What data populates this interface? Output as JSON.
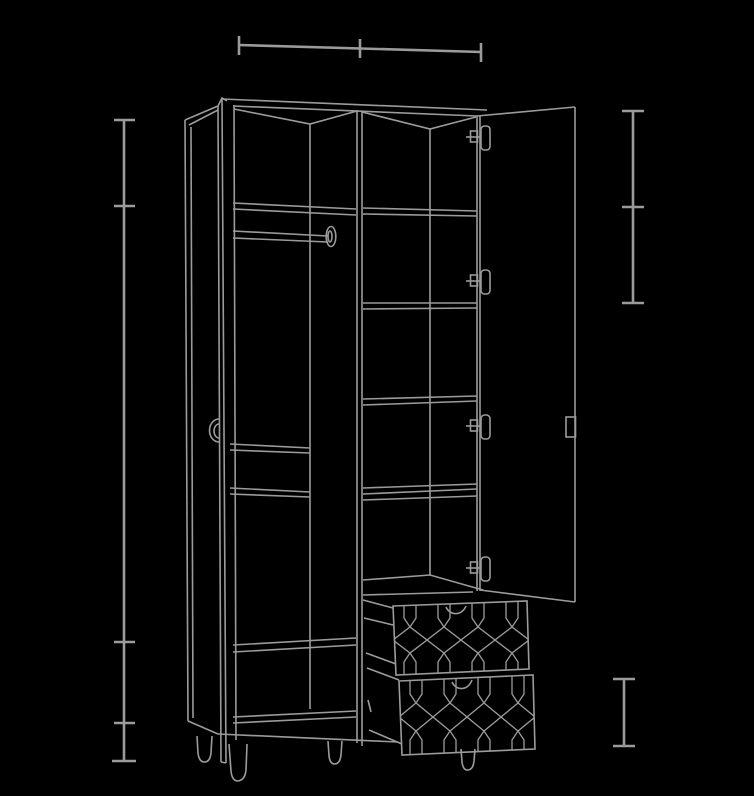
{
  "scene": {
    "type": "technical-line-drawing",
    "subject": "tall two-door wardrobe shown in perspective with both doors open, left compartment with clothes hanging rail, right compartment with five shelf levels, two pulled-out drawers with geometric trellis-pattern fronts, four round tapered feet",
    "background_color": "#000000",
    "line_color": "#9b9b9b"
  },
  "dimension_lines": [
    {
      "name": "top-width-dimension",
      "orientation": "horizontal",
      "segments": 2,
      "line": [
        239,
        45,
        481,
        52
      ],
      "ticks": [
        [
          239,
          36,
          239,
          55
        ],
        [
          360,
          39,
          360,
          58
        ],
        [
          481,
          43,
          481,
          62
        ]
      ]
    },
    {
      "name": "left-height-dimension",
      "orientation": "vertical",
      "segments": 4,
      "line": [
        124,
        120,
        124,
        761
      ],
      "ticks": [
        [
          114,
          120,
          135,
          120
        ],
        [
          114,
          206,
          135,
          206
        ],
        [
          114,
          642,
          135,
          642
        ],
        [
          114,
          723,
          135,
          723
        ],
        [
          112,
          761,
          136,
          761
        ]
      ]
    },
    {
      "name": "right-upper-height-dimension",
      "orientation": "vertical",
      "segments": 2,
      "line": [
        633,
        111,
        633,
        303
      ],
      "ticks": [
        [
          622,
          111,
          644,
          111
        ],
        [
          622,
          207,
          644,
          207
        ],
        [
          622,
          303,
          644,
          303
        ]
      ]
    },
    {
      "name": "right-lower-height-dimension",
      "orientation": "vertical",
      "segments": 1,
      "line": [
        624,
        679,
        624,
        746
      ],
      "ticks": [
        [
          613,
          679,
          635,
          679
        ],
        [
          613,
          746,
          635,
          746
        ]
      ]
    }
  ],
  "wardrobe": {
    "parts": [
      "left-side-panel",
      "left-door-open-edge-on",
      "left-door-handle",
      "carcass-top",
      "center-divider",
      "hanging-rail",
      "left-compartment-shelves",
      "right-compartment-shelves",
      "hinge-stile",
      "door-hinges",
      "right-door-open",
      "right-door-handle",
      "upper-drawer",
      "lower-drawer",
      "drawer-trellis-pattern",
      "feet"
    ],
    "hinge_count": 4,
    "drawer_count": 2,
    "feet_count": 4
  }
}
